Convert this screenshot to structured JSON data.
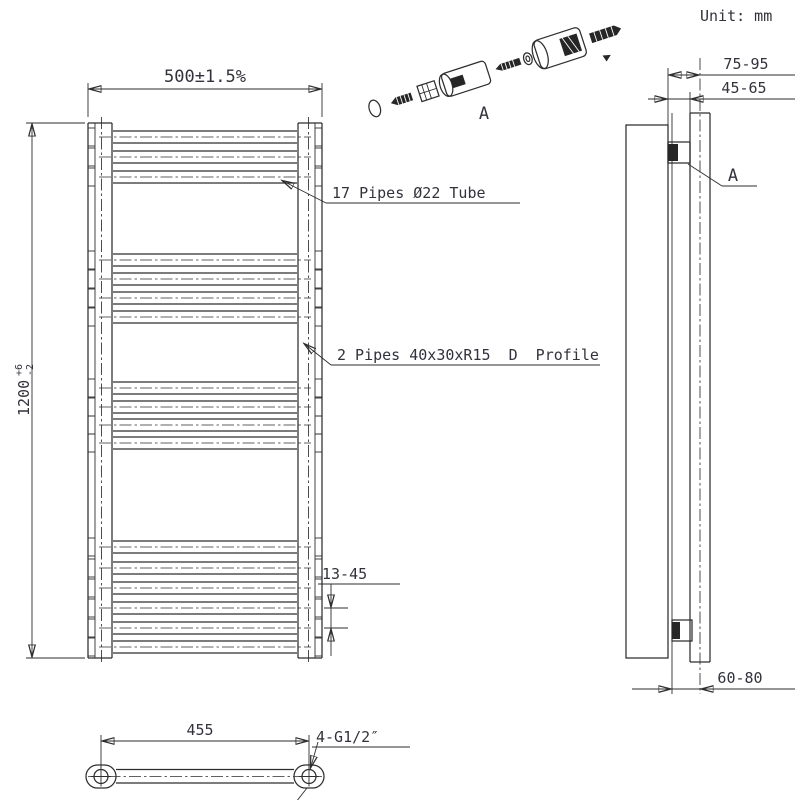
{
  "unit_label": "Unit: mm",
  "front_view": {
    "width_dim": "500±1.5%",
    "height_dim": "1200",
    "height_tol_upper": "+6",
    "height_tol_lower": "-2",
    "pipes_label": "17 Pipes Ø22 Tube",
    "profile_label": "2 Pipes 40x30xR15  D  Profile",
    "pipe_gap_dim": "13-45",
    "pipe_groups": [
      [
        137,
        157,
        177
      ],
      [
        260,
        279,
        298,
        317
      ],
      [
        388,
        407,
        425,
        443
      ],
      [
        547,
        568,
        588,
        608,
        628,
        647
      ]
    ]
  },
  "side_view": {
    "wall_offset_dim": "75-95",
    "bracket_depth_dim": "45-65",
    "bottom_offset_dim": "60-80",
    "detail_label": "A"
  },
  "exploded_view": {
    "detail_label": "A"
  },
  "bottom_view": {
    "centers_dim": "455",
    "connection_label": "4-G1/2″"
  }
}
